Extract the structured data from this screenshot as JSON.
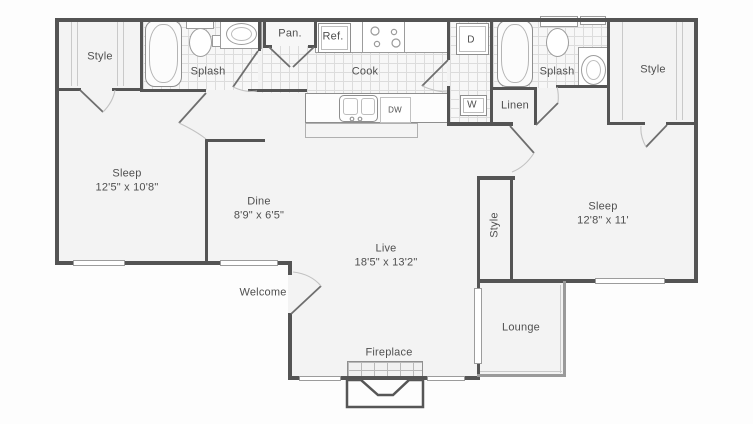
{
  "title": "Two bedroom apartment floor plan",
  "colors": {
    "wall": "#545454",
    "floor": "#f3f3f3",
    "tile_line": "#dcdcdc",
    "fixture_line": "#9c9c9c",
    "text": "#4f4f4f",
    "background": "#ffffff"
  },
  "floorplan": {
    "labels": [
      {
        "id": "closet-style-left",
        "text": "Style",
        "x": 100,
        "y": 57
      },
      {
        "id": "bath-splash-left",
        "text": "Splash",
        "x": 208,
        "y": 72
      },
      {
        "id": "pantry",
        "text": "Pan.",
        "x": 290,
        "y": 34
      },
      {
        "id": "refrigerator",
        "text": "Ref.",
        "x": 333,
        "y": 37
      },
      {
        "id": "kitchen-cook",
        "text": "Cook",
        "x": 365,
        "y": 72
      },
      {
        "id": "dryer",
        "text": "D",
        "x": 471,
        "y": 40,
        "fs": 10
      },
      {
        "id": "washer",
        "text": "W",
        "x": 472,
        "y": 105,
        "fs": 10
      },
      {
        "id": "linen",
        "text": "Linen",
        "x": 515,
        "y": 106
      },
      {
        "id": "bath-splash-right",
        "text": "Splash",
        "x": 557,
        "y": 72
      },
      {
        "id": "closet-style-right",
        "text": "Style",
        "x": 653,
        "y": 70
      },
      {
        "id": "dishwasher",
        "text": "DW",
        "x": 395,
        "y": 110,
        "fs": 8
      },
      {
        "id": "bedroom-sleep-left",
        "text": "Sleep\n12'5\" x 10'8\"",
        "x": 127,
        "y": 181
      },
      {
        "id": "dining-dine",
        "text": "Dine\n8'9\" x 6'5\"",
        "x": 259,
        "y": 209
      },
      {
        "id": "living-live",
        "text": "Live\n18'5\" x 13'2\"",
        "x": 386,
        "y": 256
      },
      {
        "id": "bedroom-sleep-right",
        "text": "Sleep\n12'8\" x 11'",
        "x": 603,
        "y": 214
      },
      {
        "id": "closet-style-vertical",
        "text": "Style",
        "x": 495,
        "y": 225,
        "rot": true
      },
      {
        "id": "entry-welcome",
        "text": "Welcome",
        "x": 263,
        "y": 293
      },
      {
        "id": "fireplace",
        "text": "Fireplace",
        "x": 389,
        "y": 353
      },
      {
        "id": "patio-lounge",
        "text": "Lounge",
        "x": 521,
        "y": 328
      }
    ]
  }
}
